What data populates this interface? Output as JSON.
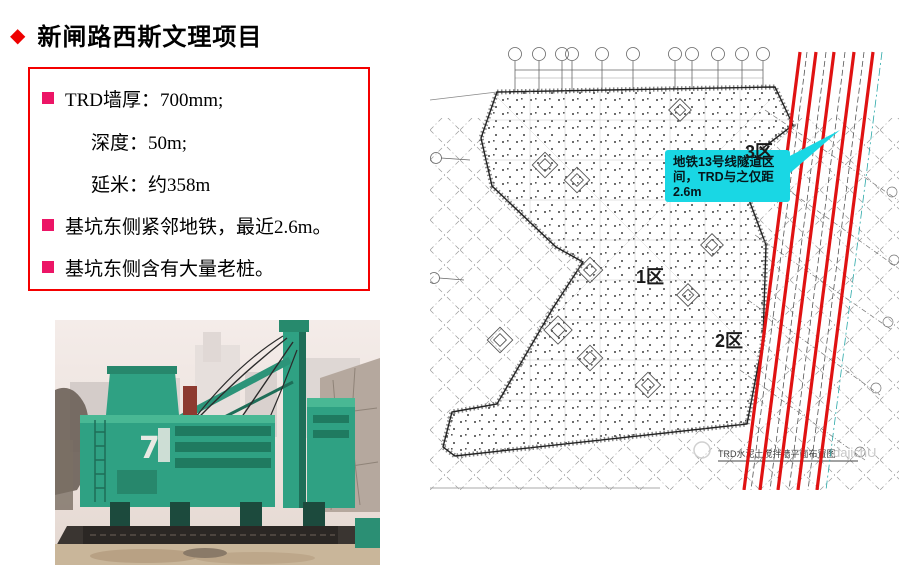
{
  "slide": {
    "title": "新闸路西斯文理项目",
    "title_diamond": "◆",
    "accent_red": "#ee0000",
    "box_border_red": "#f40000",
    "bullet_pink": "#ec1566"
  },
  "info_box": {
    "items": [
      {
        "text": "TRD墙厚：700mm;"
      },
      {
        "text": "深度：50m;"
      },
      {
        "text": "延米：约358m"
      },
      {
        "text": "基坑东侧紧邻地铁，最近2.6m。"
      },
      {
        "text": "基坑东侧含有大量老桩。"
      }
    ]
  },
  "site_plan": {
    "zone_labels": {
      "zone1": "1区",
      "zone2": "2区",
      "zone3": "3区"
    },
    "callout": {
      "line1": "地铁13号线隧道区",
      "line2": "间，TRD与之仅距",
      "line3": "2.6m",
      "bg_color": "#19d7e4"
    },
    "tunnel_line_color": "#e01212",
    "caption": "TRD水泥土搅拌墙平面布置图",
    "watermark": "dajichU"
  },
  "photo": {
    "machine_marking": "7",
    "machine_green": "#2fa183"
  }
}
